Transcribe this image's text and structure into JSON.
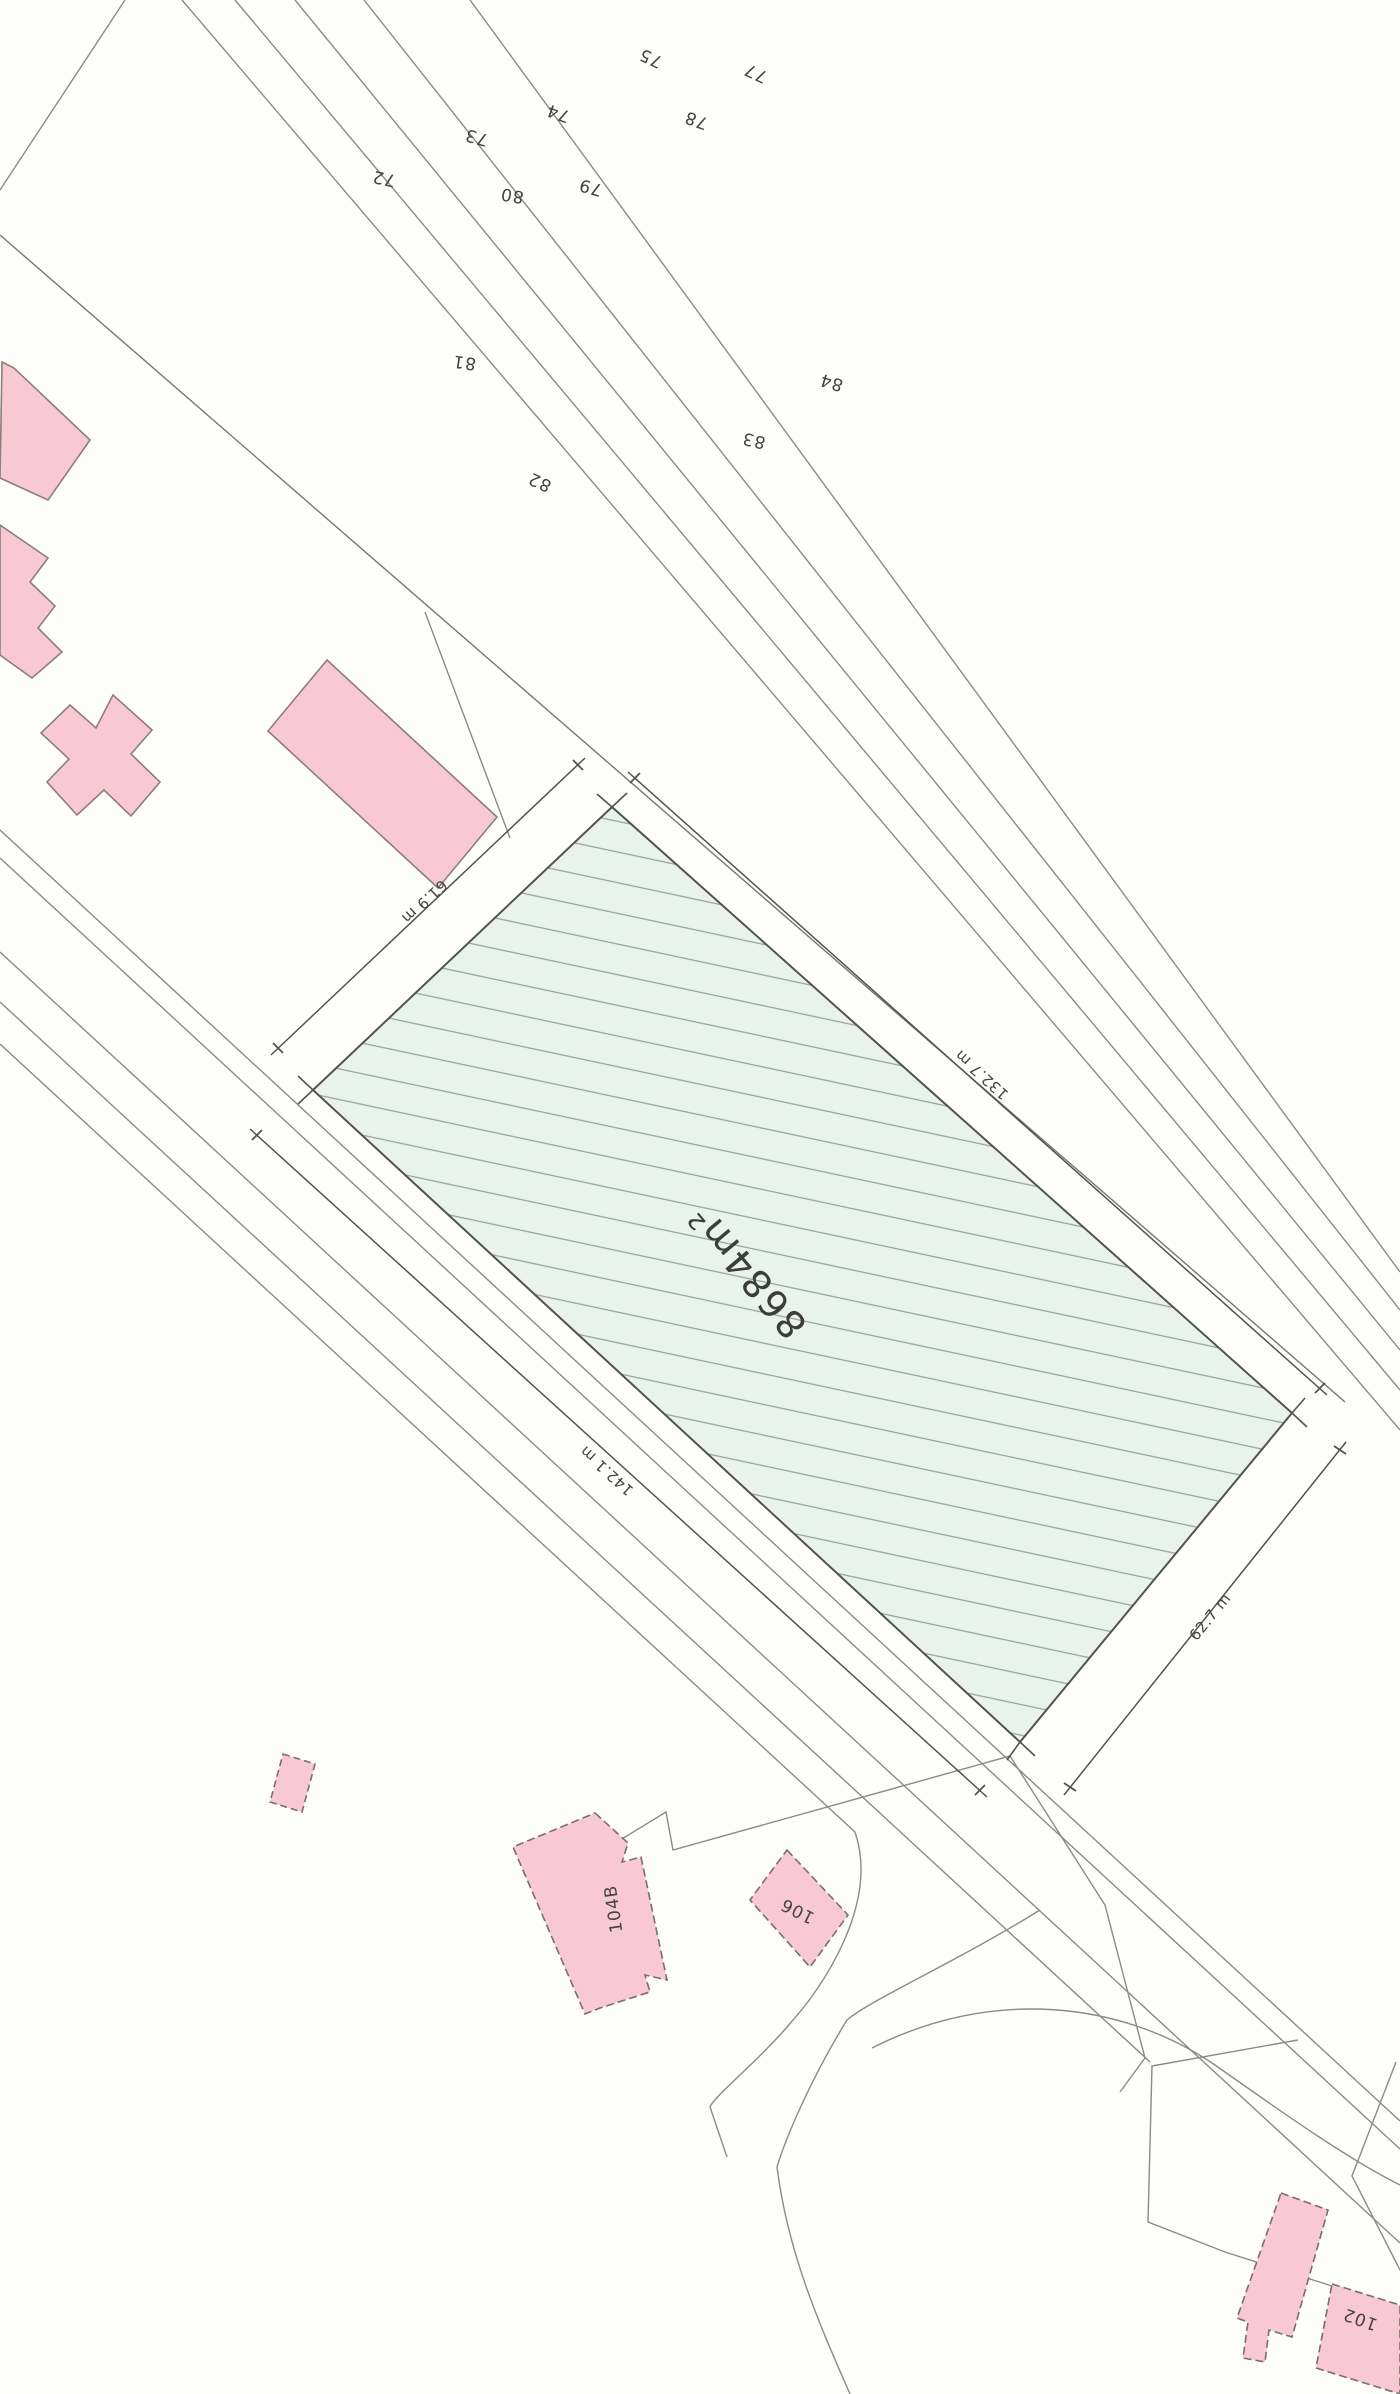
{
  "map": {
    "area_label": "8684m²",
    "dimensions": {
      "top_left": "61.9 m",
      "top_right": "132.7 m",
      "bottom_left": "142.1 m",
      "bottom_right": "62.7 m"
    },
    "house_numbers": [
      "72",
      "73",
      "74",
      "75",
      "77",
      "78",
      "79",
      "80",
      "81",
      "82",
      "83",
      "84"
    ],
    "building_labels": {
      "b104": "104B",
      "b106": "106",
      "b102": "102"
    },
    "colors": {
      "background": "#fdfdfb",
      "building_fill": "#f8c9d4",
      "building_outline": "#8d7f76",
      "parcel_fill": "#eaf2ec",
      "parcel_hatch": "#93a29a",
      "boundary": "#53534e",
      "road_line": "#8e8a84",
      "text": "#44443f"
    }
  }
}
